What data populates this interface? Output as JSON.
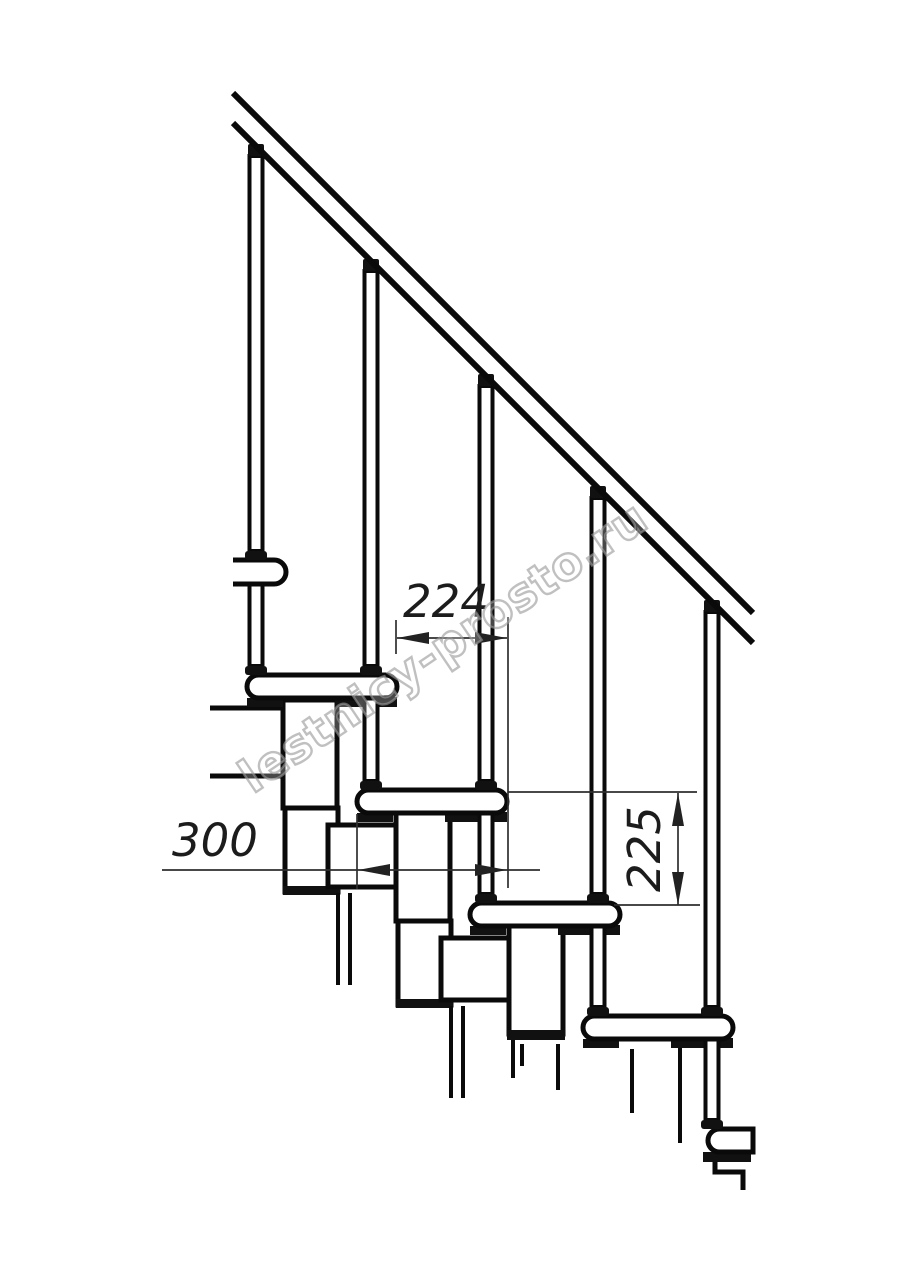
{
  "page": {
    "background": "#ffffff"
  },
  "diagram": {
    "type": "technical-line-drawing",
    "subject": "Modular staircase side-view fragment with handrail, balusters, treads and support modules",
    "watermark": "lestnicy-prosto.ru",
    "dimensions": {
      "step_going": "224",
      "tread_depth": "300",
      "step_rise": "225"
    },
    "counts": {
      "balusters": 5,
      "treads_visible": 6
    },
    "colors": {
      "line": "#0a0a0a",
      "dimension": "#2e2e2e",
      "watermark_outline": "#9a9a9a",
      "background": "#ffffff"
    }
  }
}
